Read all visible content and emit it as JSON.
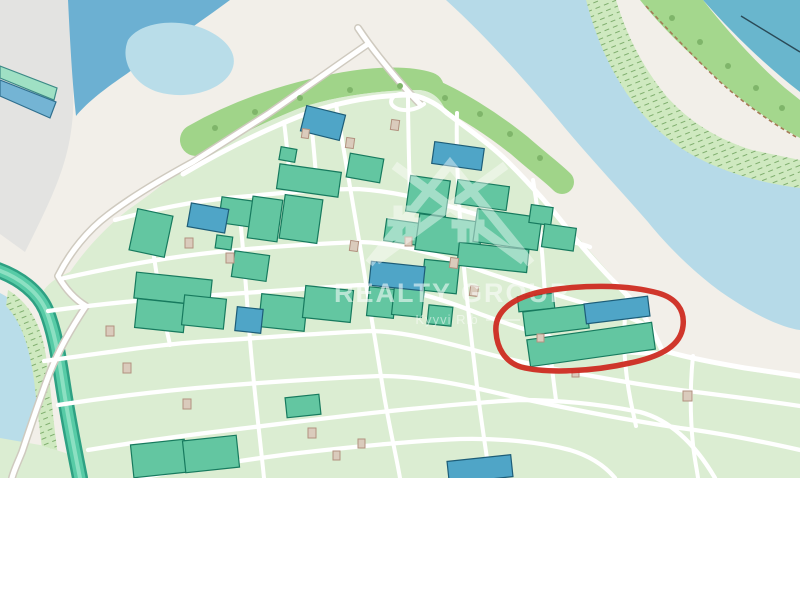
{
  "window": {
    "width": 800,
    "height": 600,
    "map_height": 478
  },
  "watermark": {
    "title": "REALTY GROUP",
    "subtitle": "Kyyvi Rib",
    "logo_icon": "realty-group-logo"
  },
  "annotation": {
    "type": "hand-drawn-ellipse",
    "purpose": "highlighted-property",
    "color": "#ce2b21"
  },
  "map_features": {
    "water": [
      "river",
      "lake",
      "harbor-corner",
      "canal",
      "pond-southwest"
    ],
    "landuse": [
      "industrial-gray-area",
      "plots-grid",
      "vegetation-band",
      "wetland-scrub",
      "sandbank"
    ],
    "structures": [
      "green-buildings",
      "blue-buildings",
      "sheds",
      "roads",
      "dashed-footpath"
    ]
  },
  "colors": {
    "land": "#f2efe9",
    "gray": "#e3e3e1",
    "waterdark": "#6cb0d2",
    "lake": "#b9dde9",
    "waterlight": "#b6dae8",
    "tealcorner": "#69b6cd",
    "canal": "#57cba6",
    "canaledge": "#2ea183",
    "canalcore": "#8ce0c2",
    "plots": "#dbedd2",
    "dots": "#c2dcb8",
    "veg": "#a0d489",
    "vegband": "#a4d78d",
    "wetland": "#cfe9c0",
    "hatch": "#7fae6e",
    "bgreen": "#63c6a1",
    "bgreenstroke": "#177a5e",
    "bblue": "#4fa5c7",
    "bbluestroke": "#1d5d78",
    "mint": "#9fe0c4",
    "shed": "#dacbbc",
    "shedstroke": "#b2917f",
    "road": "#ffffff",
    "casing": "#cfcabf",
    "path": "#a57a56",
    "red": "#ce2b21",
    "wm": "#ffffff",
    "tree": "#7fb56a",
    "beige": "#f5eee6"
  }
}
